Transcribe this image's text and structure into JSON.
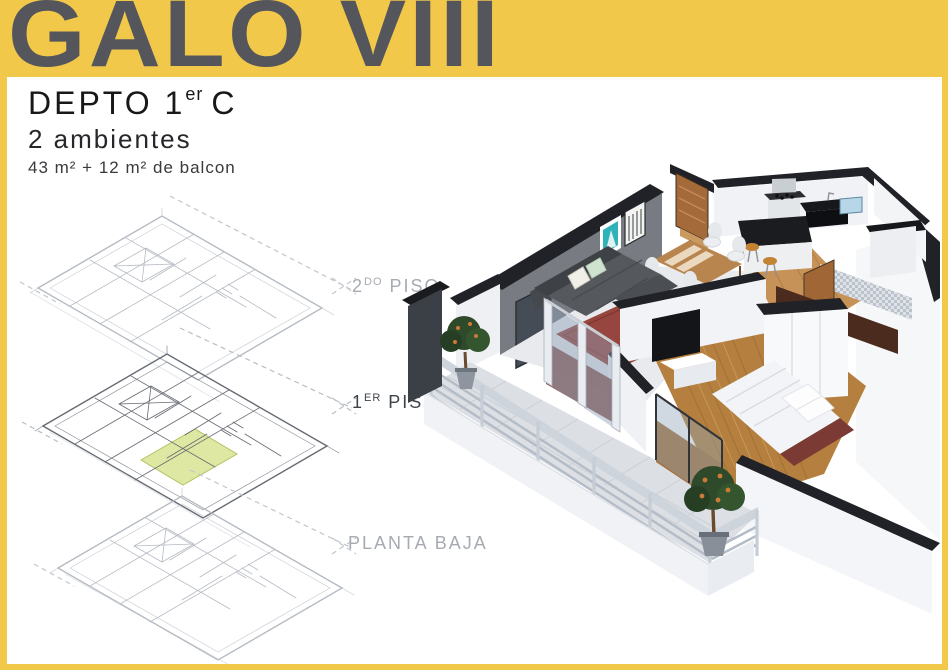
{
  "banner": {
    "title": "GALO VIII"
  },
  "unit": {
    "name_main": "DEPTO 1",
    "name_sup": "er",
    "name_tail": "C",
    "rooms": "2 ambientes",
    "area": "43 m² + 12 m² de balcon"
  },
  "floors": [
    {
      "prefix": "2",
      "sup": "DO",
      "rest": " PISO"
    },
    {
      "prefix": "1",
      "sup": "ER",
      "rest": " PISO"
    },
    {
      "prefix": "",
      "sup": "",
      "rest": "PLANTA BAJA"
    }
  ],
  "colors": {
    "frame_yellow": "#F2C84B",
    "banner_text": "#54565B",
    "highlight_lime": "#DFE8A2",
    "plan_line_light": "#B6BBC3",
    "plan_line_dark": "#666A72",
    "art_teal": "#2FB3B8",
    "rug_red": "#97463F",
    "wood_floor": "#B5803F",
    "sofa_gray": "#55585D",
    "railing_gray": "#CDD4DC",
    "tree_green": "#2E4A2B"
  }
}
